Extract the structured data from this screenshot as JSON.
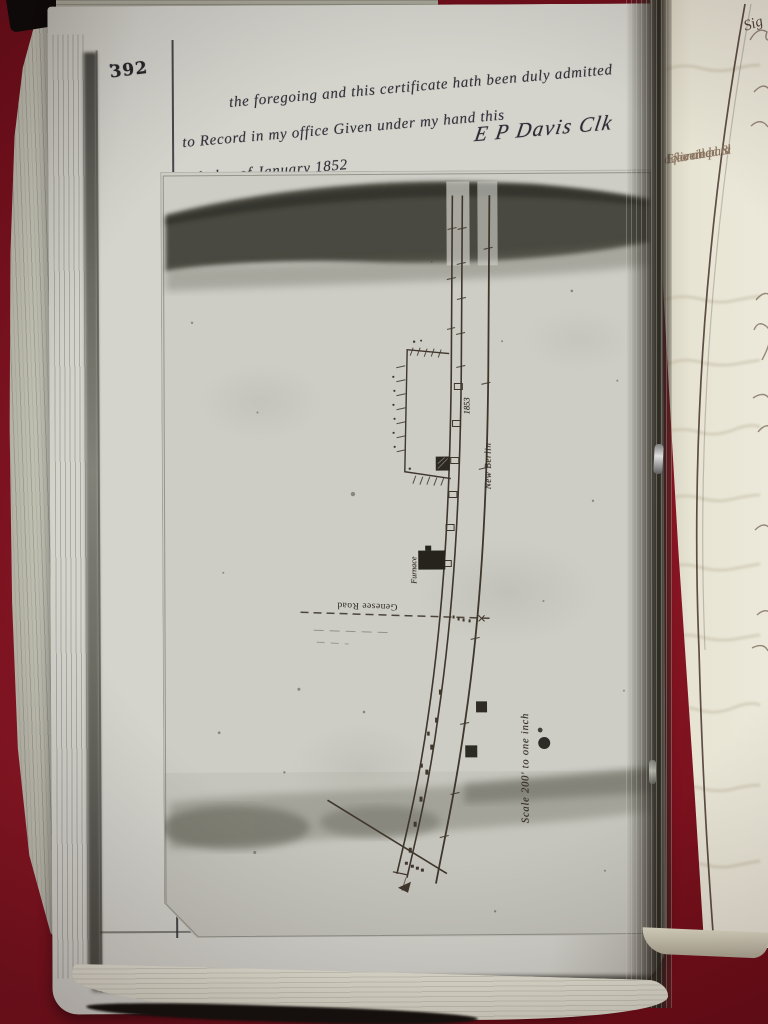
{
  "page": {
    "number": "392",
    "number_mark": "°"
  },
  "certificate": {
    "line1": "the foregoing and this certificate hath been duly admitted",
    "line2": "to Record in my office  Given under my hand this",
    "line3": "19th day of January 1852",
    "signature": "E P Davis Clk"
  },
  "map": {
    "labels": {
      "furnace": "Furnace",
      "railroad": "New Berlin",
      "year": "1853",
      "road": "Genesee Road",
      "scale": "Scale 200' to one inch"
    }
  },
  "right_page": {
    "note_line1": "Examined &",
    "note_line2": "delivered",
    "note_line3": "fee all paid",
    "edge_fragment": "Sig"
  },
  "colors": {
    "background_red": "#7d1220",
    "left_page": "#d4d4cd",
    "right_page": "#ece9da",
    "map_sheet": "#cdcdc6",
    "ink_dark": "#33323a",
    "map_ink": "#3f362c",
    "faded_ink": "#8a7460"
  }
}
